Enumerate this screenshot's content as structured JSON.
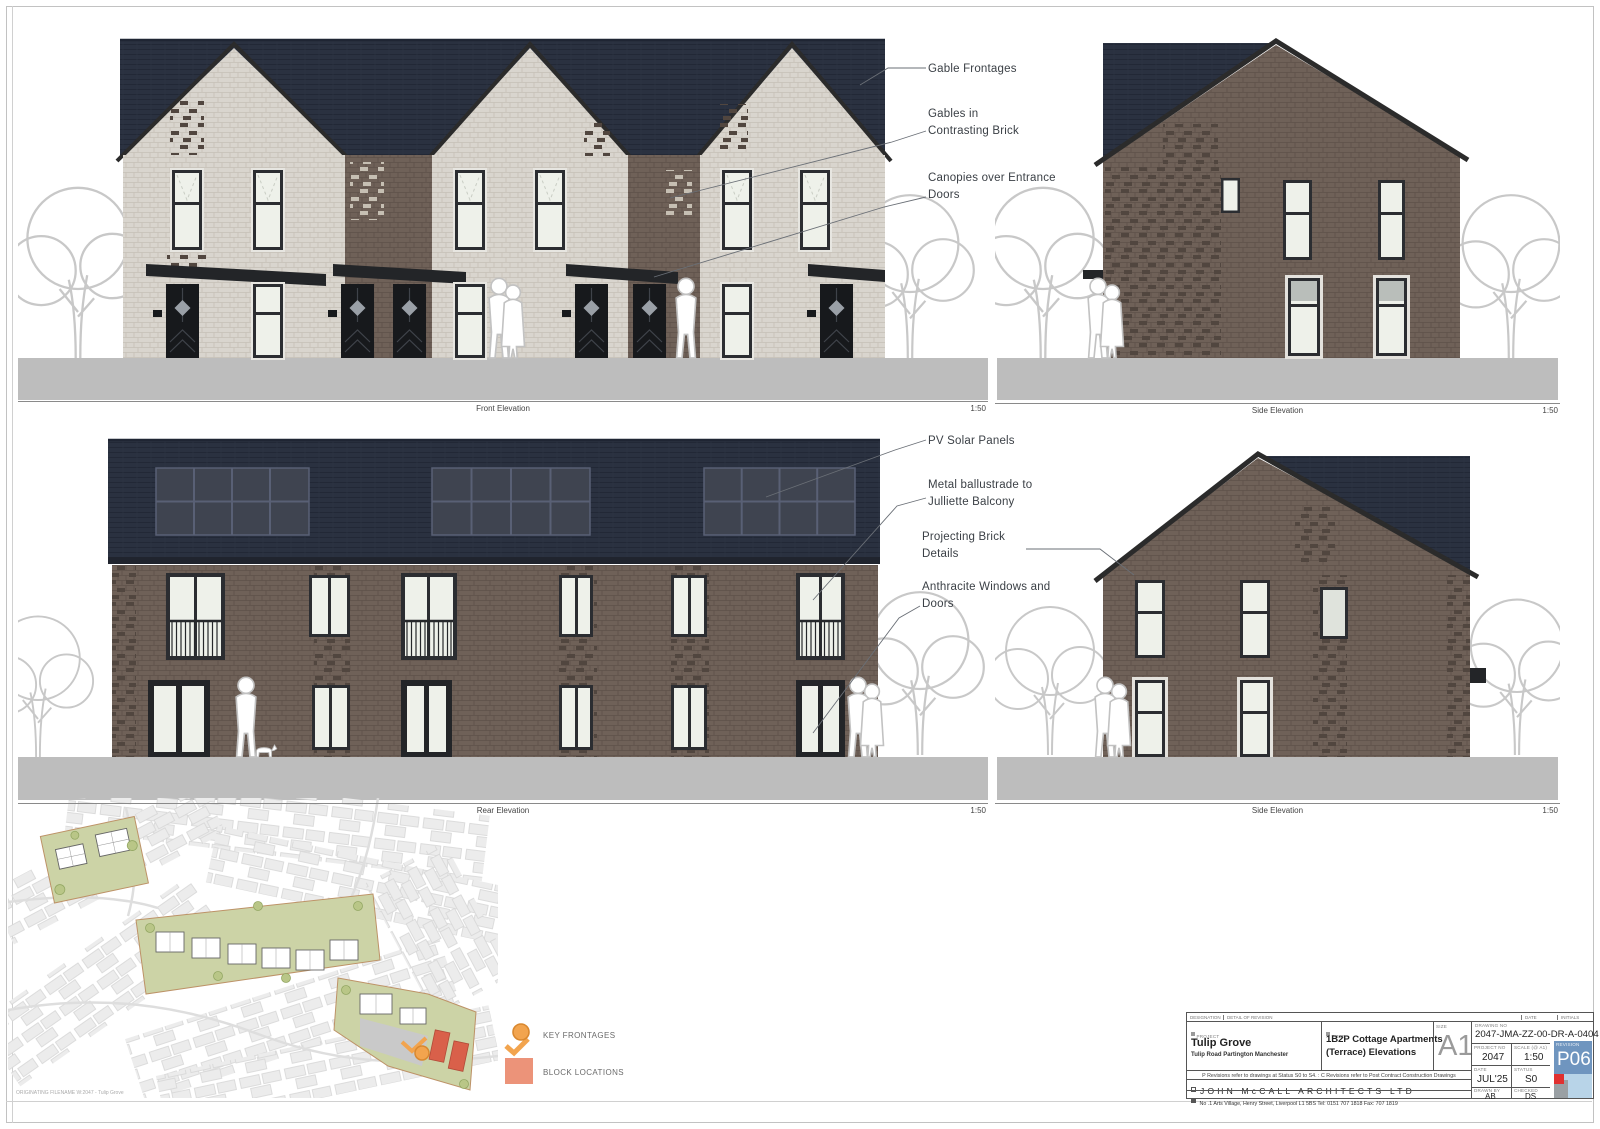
{
  "elevations": {
    "front": {
      "caption": "Front Elevation",
      "scale": "1:50"
    },
    "side_top": {
      "caption": "Side Elevation",
      "scale": "1:50"
    },
    "rear": {
      "caption": "Rear Elevation",
      "scale": "1:50"
    },
    "side_bottom": {
      "caption": "Side Elevation",
      "scale": "1:50"
    }
  },
  "annotations": {
    "front": [
      "Gable Frontages",
      "Gables in Contrasting Brick",
      "Canopies over Entrance Doors"
    ],
    "rear": [
      "PV Solar Panels",
      "Metal ballustrade to Julliette Balcony",
      "Projecting Brick Details",
      "Anthracite Windows and Doors"
    ]
  },
  "legend": {
    "key_frontages": "KEY FRONTAGES",
    "block_locations": "BLOCK LOCATIONS"
  },
  "titleblock": {
    "designation_label": "DESIGNATION",
    "detail_label": "DETAIL OF REVISION",
    "date_col_label": "DATE",
    "initials_col_label": "INITIALS",
    "project_label": "PROJECT",
    "project_name": "Tulip Grove",
    "project_address": "Tulip Road Partington  Manchester",
    "title_label": "TITLE",
    "drawing_title_line1": "1B2P Cottage Apartments",
    "drawing_title_line2": "(Terrace) Elevations",
    "size_label": "SIZE",
    "size": "A1",
    "drawing_no_label": "DRAWING No",
    "drawing_no": "2047-JMA-ZZ-00-DR-A-0404",
    "project_no_label": "PROJECT No",
    "project_no": "2047",
    "scale_label": "SCALE (@ A1)",
    "scale": "1:50",
    "revision_label": "REVISION",
    "revision": "P06",
    "date_label": "DATE",
    "date": "JUL'25",
    "status_label": "STATUS",
    "status": "S0",
    "drawn_label": "DRAWN BY",
    "drawn": "AB",
    "checked_label": "CHECKED",
    "checked": "DS",
    "revisions_note": "P Revisions refer to drawings at Status S0 to S4.  :  C Revisions refer to Post Contract Construction Drawings",
    "firm_name": "JOHN McCALL ARCHITECTS LTD",
    "firm_address": "No .1 Arts Village,  Henry  Street,  Liverpool  L1 5BS   Tel:  0151 707 1818   Fax:  707 1819"
  },
  "footer": {
    "note": "ORIGINATING FILENAME  W:2047 - Tulip Grove"
  },
  "colors": {
    "roof": "#2a3140",
    "brick_light": "#d9d5ce",
    "brick_dark": "#6f6158",
    "ground": "#bdbdbd",
    "revision_blue": "#6f95bf",
    "legend_orange": "#f2a44e",
    "legend_salmon": "#ec9379",
    "site_green": "#ccd3a6",
    "site_red": "#d9604a"
  }
}
